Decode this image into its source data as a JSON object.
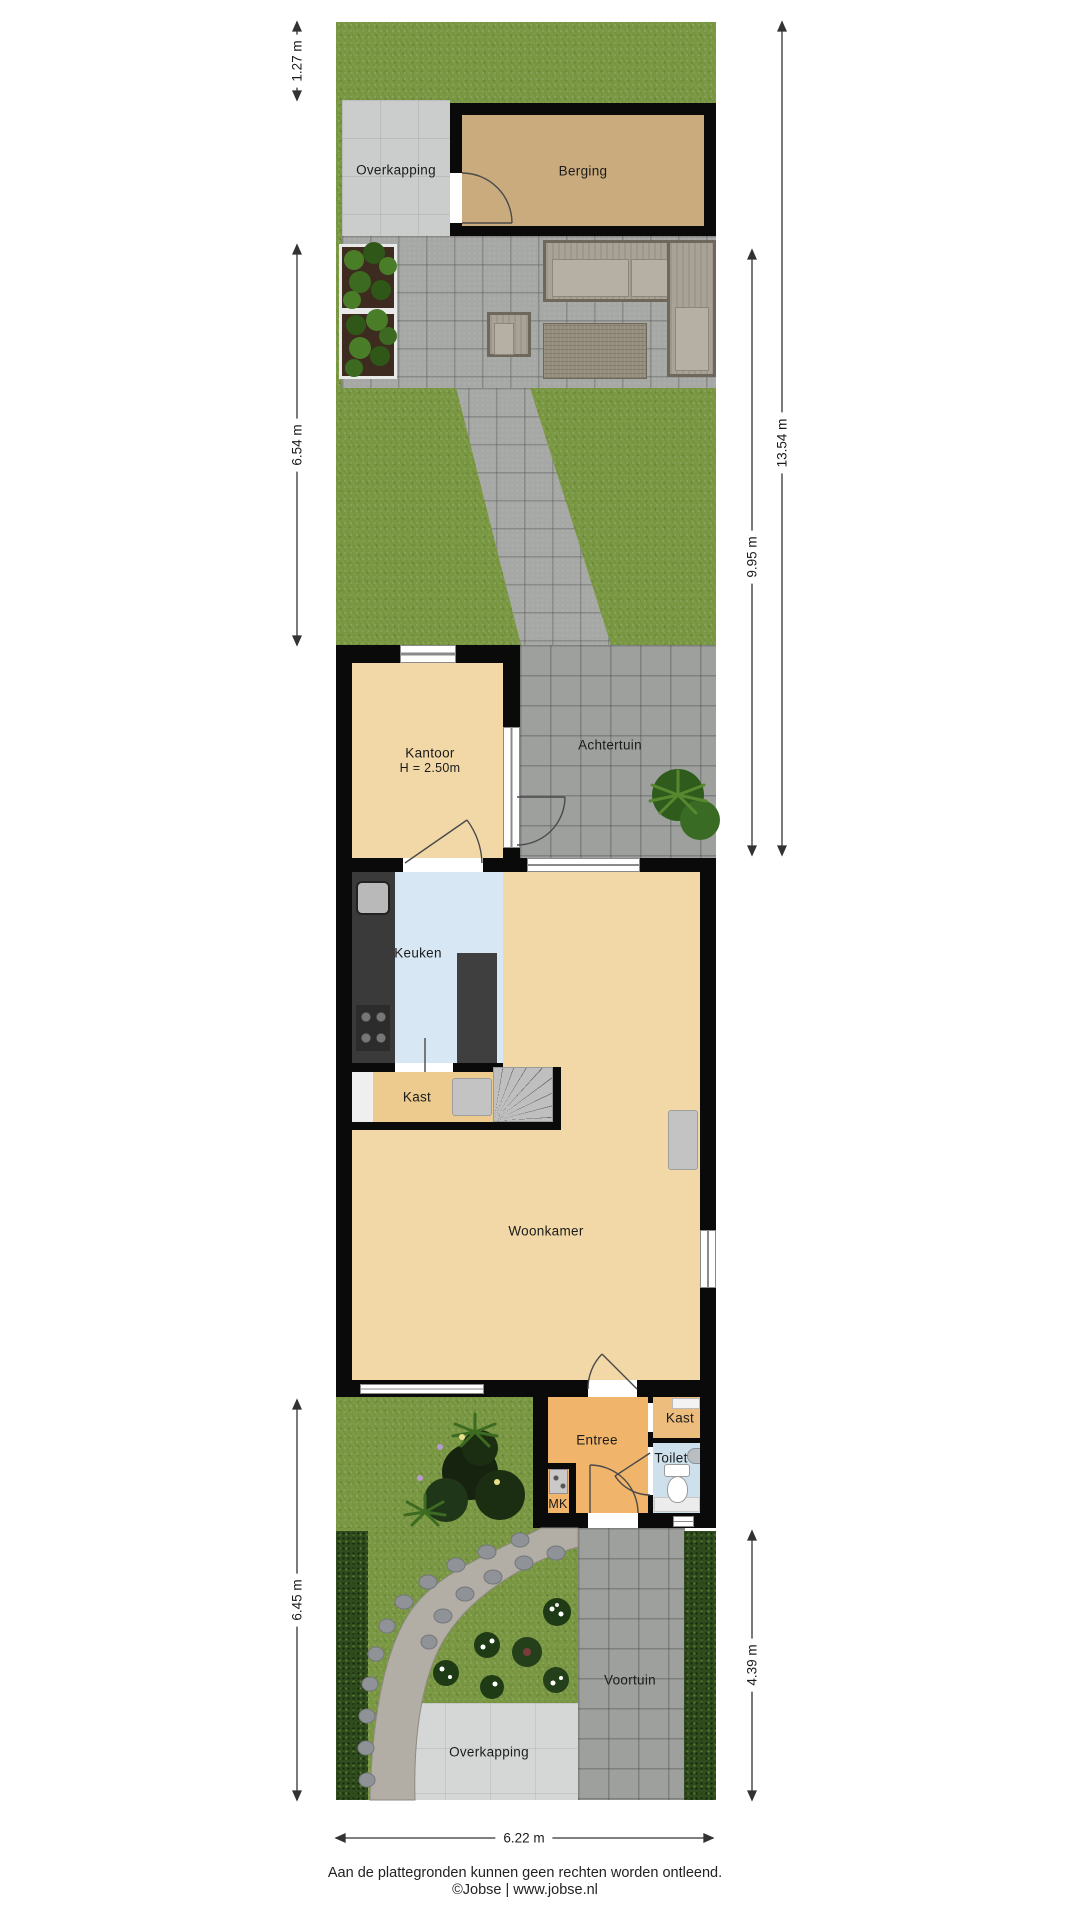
{
  "labels": {
    "overkapping_top": "Overkapping",
    "berging": "Berging",
    "achtertuin": "Achtertuin",
    "kantoor": "Kantoor",
    "kantoor_height": "H = 2.50m",
    "keuken": "Keuken",
    "kast_mid": "Kast",
    "woonkamer": "Woonkamer",
    "entree": "Entree",
    "kast_bottom": "Kast",
    "toilet": "Toilet",
    "mk": "MK",
    "voortuin": "Voortuin",
    "overkapping_bottom": "Overkapping"
  },
  "dimensions": {
    "top_strip": "1.27 m",
    "back_garden_left": "6.54 m",
    "front_garden_left": "6.45 m",
    "total_right": "13.54 m",
    "back_garden_right": "9.95 m",
    "front_garden_right": "4.39 m",
    "width_bottom": "6.22 m"
  },
  "footer": {
    "disclaimer": "Aan de plattegronden kunnen geen rechten worden ontleend.",
    "credit": "©Jobse | www.jobse.nl"
  },
  "colors": {
    "grass": "#7c9a45",
    "hedge": "#2e4c1d",
    "paving": "#a6a8a5",
    "floor_wood": "#f2d8a6",
    "floor_entree": "#f0b46a",
    "floor_kitchen": "#d8e7f4",
    "floor_toilet": "#cfe0ed",
    "floor_berging": "#c9ab7e",
    "wall": "#0a0a0a"
  }
}
